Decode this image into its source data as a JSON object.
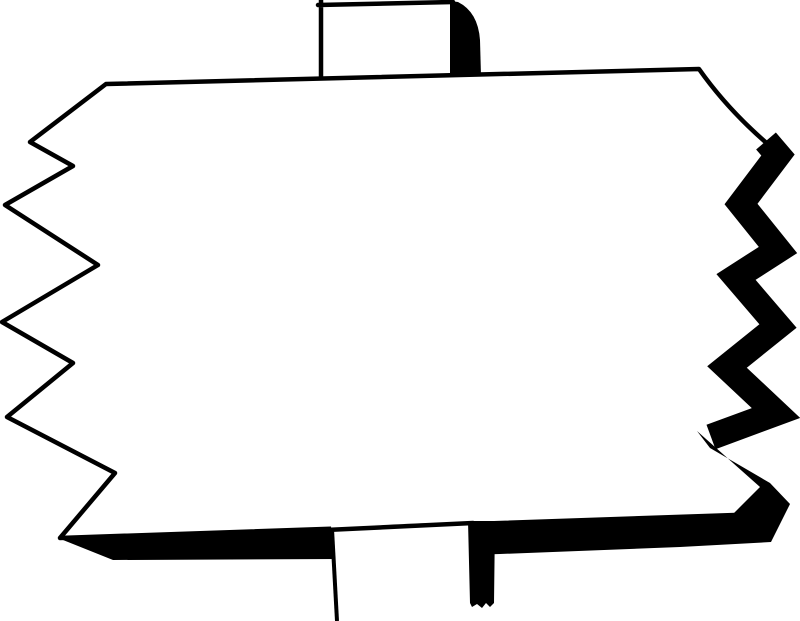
{
  "title": "Blank signpost clipart",
  "sign": {
    "text": ""
  },
  "colors": {
    "ink": "#000000",
    "background": "#ffffff",
    "paper": "#ffffff"
  }
}
